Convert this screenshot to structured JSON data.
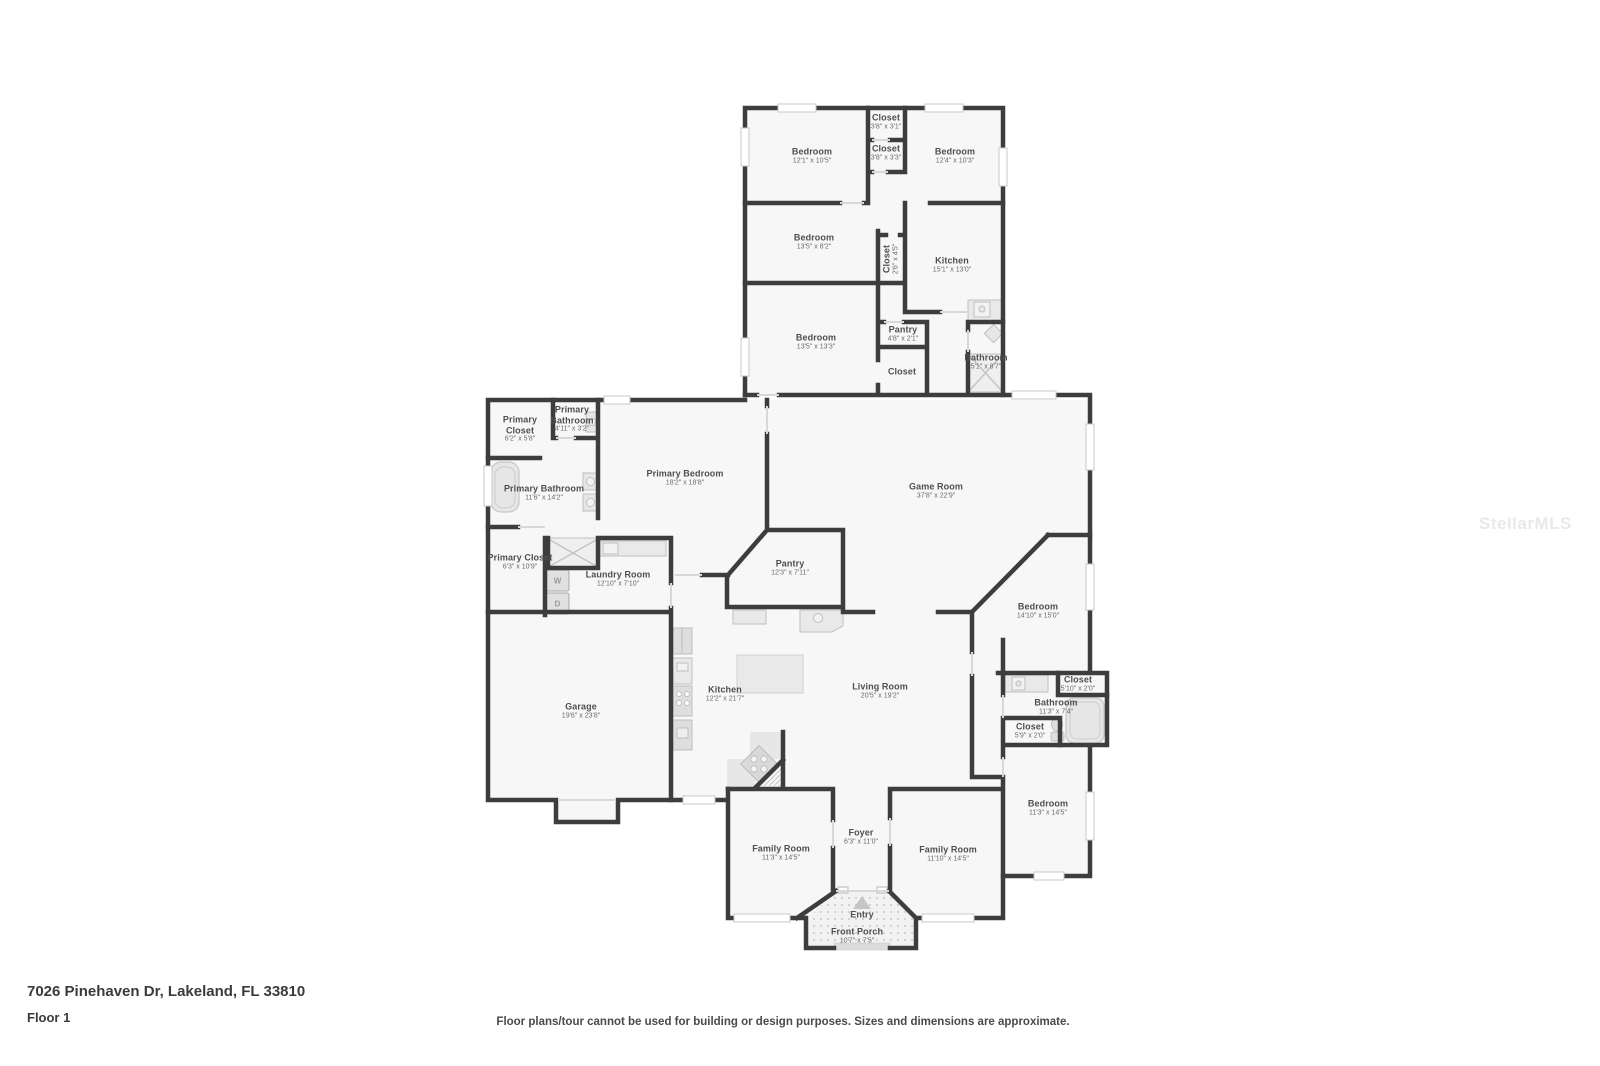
{
  "page": {
    "address": "7026 Pinehaven Dr, Lakeland, FL 33810",
    "floor_label": "Floor 1",
    "disclaimer": "Floor plans/tour cannot be used for building or design purposes. Sizes and dimensions are approximate.",
    "watermark": "StellarMLS"
  },
  "colors": {
    "wall": "#3d3d3d",
    "room_fill": "#f7f7f7",
    "fixture": "#e6e6e6",
    "label_text": "#4f4f4f",
    "window_frame": "#c9c9c9",
    "watermark": "#e9e9e9"
  },
  "appliances": {
    "washer": "W",
    "dryer": "D"
  },
  "rooms": {
    "bedroom_top_left": {
      "name": "Bedroom",
      "dims": "12'1\" x 10'5\""
    },
    "closet_top_1": {
      "name": "Closet",
      "dims": "3'8\" x 3'1\""
    },
    "closet_top_2": {
      "name": "Closet",
      "dims": "3'8\" x 3'3\""
    },
    "bedroom_top_right": {
      "name": "Bedroom",
      "dims": "12'4\" x 10'3\""
    },
    "bedroom_mid_left": {
      "name": "Bedroom",
      "dims": "13'5\" x 8'2\""
    },
    "closet_vertical": {
      "name": "Closet",
      "dims": "2'6\" x 4'5\""
    },
    "kitchen_upper": {
      "name": "Kitchen",
      "dims": "15'1\" x 13'0\""
    },
    "bedroom_lower_left": {
      "name": "Bedroom",
      "dims": "13'5\" x 13'3\""
    },
    "pantry_upper": {
      "name": "Pantry",
      "dims": "4'8\" x 2'1\""
    },
    "closet_upper_3": {
      "name": "Closet",
      "dims": ""
    },
    "bathroom_upper": {
      "name": "Bathroom",
      "dims": "5'1\" x 8'7\""
    },
    "primary_closet_1": {
      "name": "Primary Closet",
      "dims": "6'2\" x 5'8\""
    },
    "primary_bathroom_wc": {
      "name": "Primary Bathroom",
      "dims": "4'11\" x 3'2\""
    },
    "primary_bathroom": {
      "name": "Primary Bathroom",
      "dims": "11'6\" x 14'2\""
    },
    "primary_closet_2": {
      "name": "Primary Closet",
      "dims": "6'3\" x 10'9\""
    },
    "primary_bedroom": {
      "name": "Primary Bedroom",
      "dims": "18'2\" x 18'8\""
    },
    "laundry_room": {
      "name": "Laundry Room",
      "dims": "12'10\" x 7'10\""
    },
    "pantry_main": {
      "name": "Pantry",
      "dims": "12'3\" x 7'11\""
    },
    "game_room": {
      "name": "Game Room",
      "dims": "37'8\" x 22'9\""
    },
    "bedroom_right_1": {
      "name": "Bedroom",
      "dims": "14'10\" x 15'0\""
    },
    "garage": {
      "name": "Garage",
      "dims": "19'6\" x 23'8\""
    },
    "kitchen_main": {
      "name": "Kitchen",
      "dims": "12'2\" x 21'7\""
    },
    "living_room": {
      "name": "Living Room",
      "dims": "20'5\" x 19'2\""
    },
    "closet_right_1": {
      "name": "Closet",
      "dims": "5'10\" x 2'0\""
    },
    "bathroom_right": {
      "name": "Bathroom",
      "dims": "11'3\" x 7'4\""
    },
    "closet_right_2": {
      "name": "Closet",
      "dims": "5'9\" x 2'0\""
    },
    "bedroom_right_2": {
      "name": "Bedroom",
      "dims": "11'3\" x 14'5\""
    },
    "family_room_left": {
      "name": "Family Room",
      "dims": "11'3\" x 14'5\""
    },
    "foyer": {
      "name": "Foyer",
      "dims": "6'3\" x 11'0\""
    },
    "family_room_right": {
      "name": "Family Room",
      "dims": "11'10\" x 14'5\""
    },
    "entry": {
      "name": "Entry",
      "dims": ""
    },
    "front_porch": {
      "name": "Front Porch",
      "dims": "10'7\" x 7'5\""
    }
  }
}
